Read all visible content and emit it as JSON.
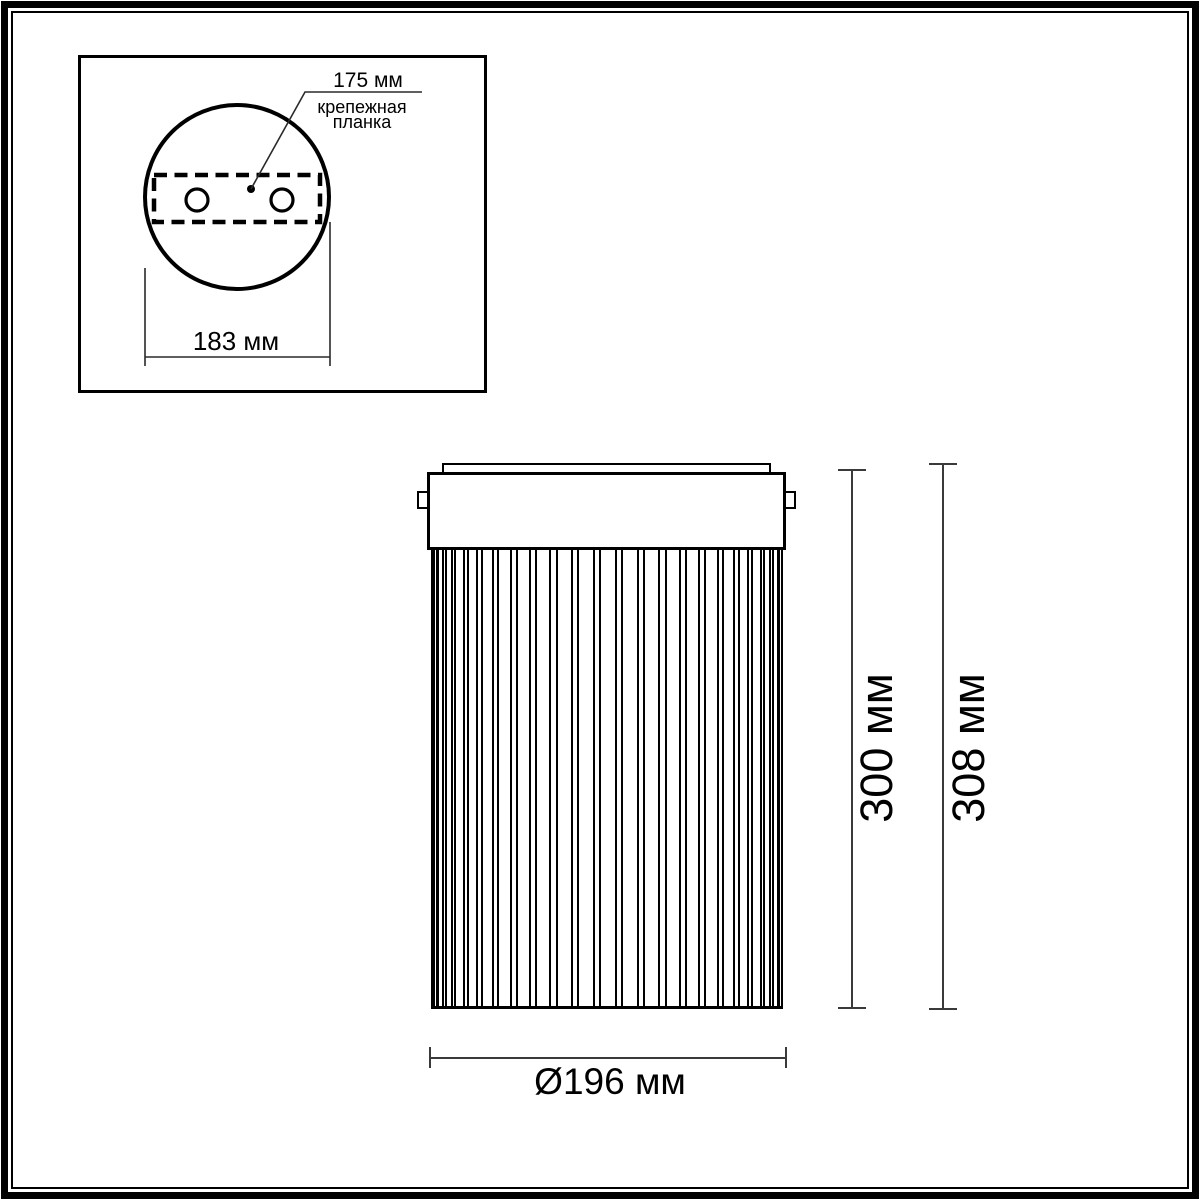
{
  "inset": {
    "hole_spacing_label": "175 мм",
    "bracket_label_line1": "крепежная",
    "bracket_label_line2": "планка",
    "plate_width_label": "183 мм"
  },
  "front_view": {
    "shade_height_label": "300 мм",
    "total_height_label": "308 мм",
    "diameter_label": "Ø196 мм"
  },
  "colors": {
    "line": "#000000",
    "dimension": "#3a3a3a",
    "background": "#ffffff"
  }
}
